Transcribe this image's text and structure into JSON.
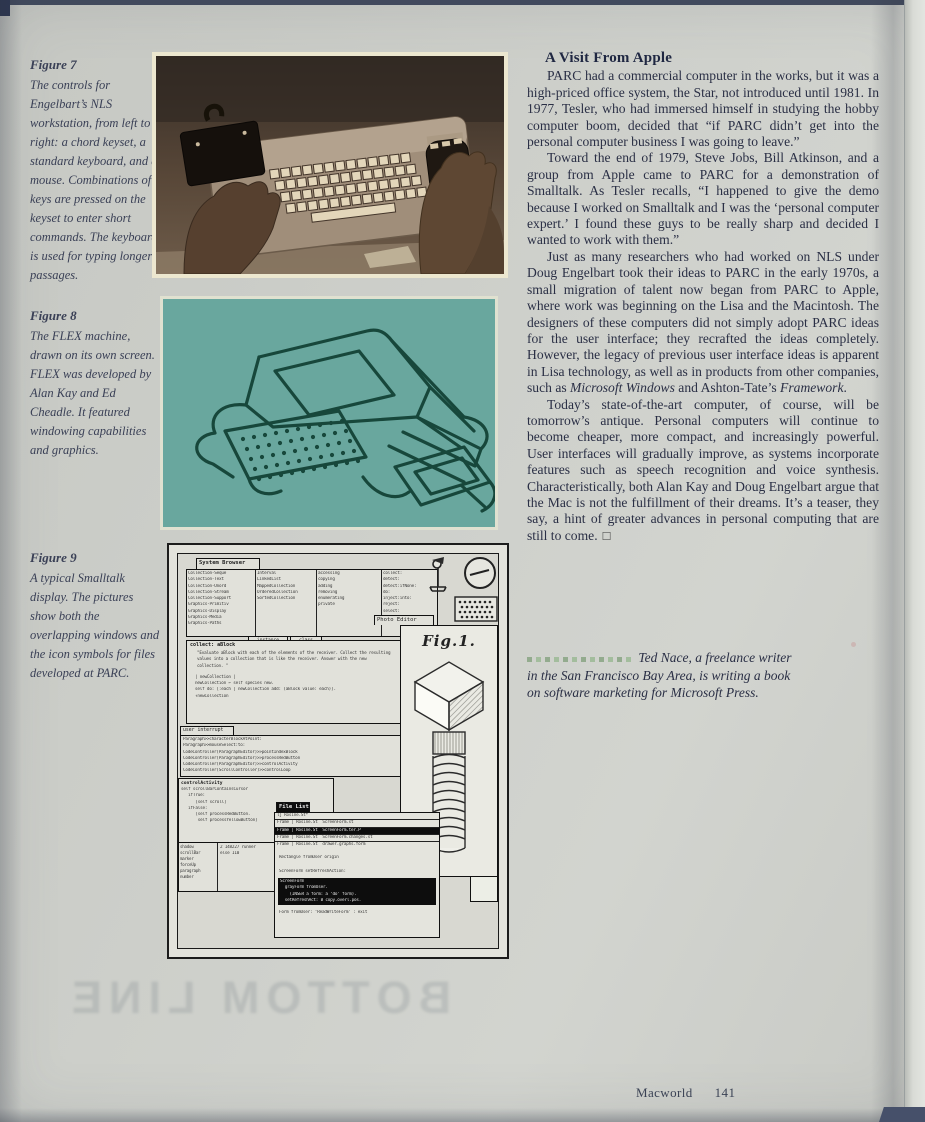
{
  "page": {
    "footer": {
      "magazine": "Macworld",
      "page_number": "141"
    },
    "ghost_text": "BOTTOM LINE"
  },
  "colors": {
    "paper": "#cdcfca",
    "ink": "#2a2f45",
    "caption_ink": "#3a4056",
    "teal_background": "#69a79e",
    "teal_line": "#17473b",
    "byline_dot_green": "#a3bd9d",
    "sepia_dark": "#38302a",
    "sepia_light": "#b3a28e"
  },
  "captions": {
    "fig7": {
      "title": "Figure 7",
      "text": "The controls for Engelbart’s NLS workstation, from left to right: a chord keyset, a standard keyboard, and a mouse. Combinations of keys are pressed on the keyset to enter short commands. The keyboard is used for typing longer passages."
    },
    "fig8": {
      "title": "Figure 8",
      "text": "The FLEX machine, drawn on its own screen. FLEX was developed by Alan Kay and Ed Cheadle. It featured windowing capabilities and graphics."
    },
    "fig9": {
      "title": "Figure 9",
      "text": "A typical Smalltalk display. The pictures show both the overlapping windows and the icon symbols for files developed at PARC."
    }
  },
  "article": {
    "headline": "A Visit From Apple",
    "p1": "PARC had a commercial computer in the works, but it was a high-priced office system, the Star, not introduced until 1981. In 1977, Tesler, who had immersed himself in studying the hobby computer boom, decided that “if PARC didn’t get into the personal computer business I was going to leave.”",
    "p2": "Toward the end of 1979, Steve Jobs, Bill Atkinson, and a group from Apple came to PARC for a demonstration of Smalltalk. As Tesler recalls, “I happened to give the demo because I worked on Smalltalk and I was the ‘personal computer expert.’ I found these guys to be really sharp and decided I wanted to work with them.”",
    "p3a": "Just as many researchers who had worked on NLS under Doug Engelbart took their ideas to PARC in the early 1970s, a small migration of talent now began from PARC to Apple, where work was beginning on the Lisa and the Macintosh. The designers of these computers did not simply adopt PARC ideas for the user interface; they recrafted the ideas completely. However, the legacy of previous user interface ideas is apparent in Lisa technology, as well as in products from other companies, such as ",
    "p3_italic1": "Microsoft Windows",
    "p3b": " and Ashton-Tate’s ",
    "p3_italic2": "Framework",
    "p3c": ".",
    "p4": "Today’s state-of-the-art computer, of course, will be tomorrow’s antique. Personal computers will continue to become cheaper, more compact, and increasingly powerful. User interfaces will gradually improve, as systems incorporate features such as speech recognition and voice synthesis. Characteristically, both Alan Kay and Doug Engelbart argue that the Mac is not the fulfillment of their dreams. It’s a teaser, they say, a hint of greater advances in personal computing that are still to come.",
    "end_mark": "☐",
    "byline": "Ted Nace, a freelance writer in the San Francisco Bay Area, is writing a book on software marketing for Microsoft Press."
  },
  "smalltalk_screen": {
    "browser": {
      "title": "System Browser",
      "col1": [
        "Collection-Seque",
        "Collection-Text",
        "Collection-Unord",
        "Collection-Stream",
        "Collection-Support",
        "Graphics-Primitiv",
        "Graphics-Display",
        "Graphics-Media",
        "Graphics-Paths"
      ],
      "col2": [
        "Interval",
        "LinkedList",
        "MappedCollection",
        "OrderedCollection",
        "SortedCollection"
      ],
      "col3": [
        "accessing",
        "copying",
        "adding",
        "removing",
        "enumerating",
        "private"
      ],
      "col4": [
        "collect:",
        "detect:",
        "detect:ifNone:",
        "do:",
        "inject:into:",
        "reject:",
        "select:"
      ],
      "subtab_instance": "instance",
      "subtab_class": "class",
      "photo_tab": "Photo Editor"
    },
    "method_window": {
      "title": "collect: aBlock",
      "comment": "\"Evaluate aBlock with each of the elements of the receiver. Collect the resulting values into a collection that is like the receiver.  Answer with the new collection. \"",
      "code1": "| newCollection |",
      "code2": "newCollection ← self species new.",
      "code3": "self do: [:each | newCollection add: (aBlock value: each)].",
      "code4": "↑newCollection"
    },
    "interrupt_window": {
      "title": "user interrupt",
      "stack": [
        "Paragraph>>characterBlockAtPoint:",
        "Paragraph>>mouseSelect:to:",
        "CodeController(ParagraphEditor)>>pointIndexBlock",
        "CodeController(ParagraphEditor)>>processRedButton",
        "CodeController(ParagraphEditor)>>controlActivity",
        "CodeController(ScrollController)>>controlLoop"
      ]
    },
    "control_window": {
      "title": "controlActivity",
      "lines": [
        "self scrollBarContainsCursor",
        "   ifTrue:",
        "      [self scroll]",
        "   ifFalse:",
        "      [self processRedButton.",
        "       self processYellowButton]"
      ]
    },
    "mini_window": {
      "left": [
        "shadow",
        "scrollBar",
        "marker",
        "forceUp",
        "paragraph",
        "number"
      ],
      "right": [
        "2 148227 runner",
        "else 110"
      ]
    },
    "filelist": {
      "title": "File List",
      "rows": [
        "lj Rosine.St*",
        "Frame | Rosine.St  ScreenForm.st",
        "Frame | Rosine.St  ScreenForm.ter.P",
        "Frame | Rosine.St  ScreenForm.changes.st",
        "Frame | Rosine.St  drawer.graphs.form"
      ],
      "line1": "Rectangle fromUser origin",
      "line2": "ScreenForm setRefreshAction:",
      "black_lines": [
        "ScreenForm",
        "  grayForm fromUser.",
        "    (INSER a form: a ‘do’ form).",
        "  setRefreshAct: B copy.overl.pos."
      ],
      "footer_line": "Form fromUser: ‘ReadWriteForm’ : exit"
    },
    "fig1_window": {
      "label": "Fig.1."
    },
    "icons": [
      "joystick-icon",
      "clock-icon",
      "halftone-grid-icon"
    ]
  }
}
